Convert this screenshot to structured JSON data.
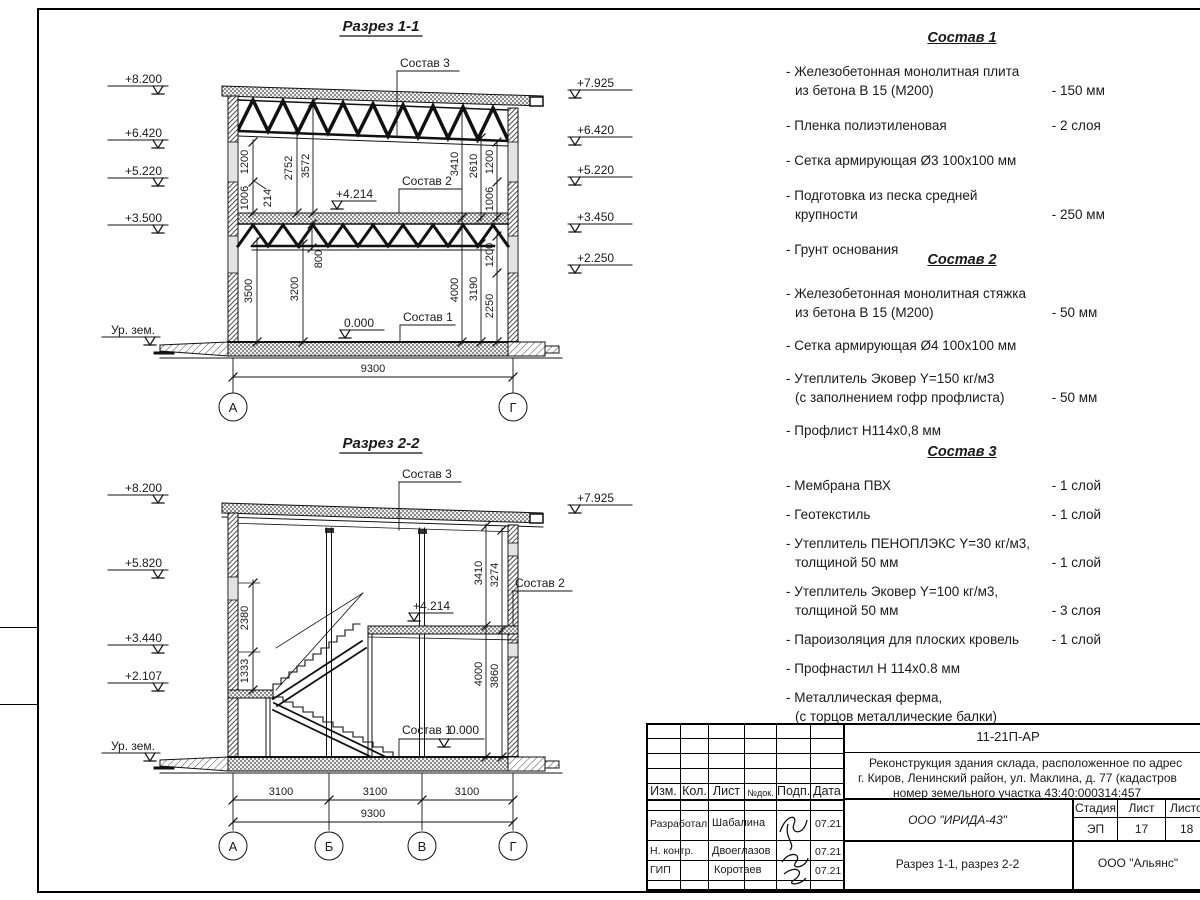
{
  "labels": {
    "c1": "Состав 1",
    "c2": "Состав 2",
    "c3": "Состав 3"
  },
  "s1": {
    "title": "Разрез 1-1",
    "elev_left": [
      "+8.200",
      "+6.420",
      "+5.220",
      "+3.500"
    ],
    "elev_right": [
      "+7.925",
      "+6.420",
      "+5.220",
      "+3.450",
      "+2.250"
    ],
    "ground": "Ур. зем.",
    "du_left": [
      "1200",
      "1006",
      "214",
      "2752",
      "3572"
    ],
    "du_right": [
      "3410",
      "2610",
      "1200",
      "1006"
    ],
    "dl_left": [
      "3500",
      "3200",
      "800"
    ],
    "dl_right": [
      "4000",
      "3190",
      "2250",
      "1200"
    ],
    "lvl_mid": "+4.214",
    "lvl_zero": "0.000",
    "span": "9300",
    "axes": [
      "А",
      "Г"
    ]
  },
  "s2": {
    "title": "Разрез 2-2",
    "elev_left": [
      "+8.200",
      "+5.820",
      "+3.440",
      "+2.107"
    ],
    "elev_right": [
      "+7.925"
    ],
    "ground": "Ур. зем.",
    "d_left": [
      "2380",
      "1333"
    ],
    "d_right_up": [
      "3410",
      "3274"
    ],
    "d_right_low": [
      "4000",
      "3860"
    ],
    "lvl_mid": "+4.214",
    "lvl_zero": "0.000",
    "spans": [
      "3100",
      "3100",
      "3100"
    ],
    "total": "9300",
    "axes": [
      "А",
      "Б",
      "В",
      "Г"
    ]
  },
  "compositions": [
    {
      "title": "Состав 1",
      "items": [
        {
          "text": "- Железобетонная  монолитная плита\nиз бетона В 15 (М200)",
          "value": "- 150 мм"
        },
        {
          "text": "- Пленка полиэтиленовая",
          "value": "- 2 слоя"
        },
        {
          "text": "- Сетка армирующая Ø3 100х100 мм",
          "value": ""
        },
        {
          "text": "- Подготовка из песка средней\nкрупности",
          "value": "- 250 мм"
        },
        {
          "text": "- Грунт основания",
          "value": ""
        }
      ]
    },
    {
      "title": "Состав 2",
      "items": [
        {
          "text": "- Железобетонная  монолитная стяжка\nиз бетона В 15 (М200)",
          "value": "- 50 мм"
        },
        {
          "text": "- Сетка армирующая Ø4 100х100 мм",
          "value": ""
        },
        {
          "text": "- Утеплитель Эковер Y=150 кг/м3\n(с заполнением гофр профлиста)",
          "value": "- 50 мм"
        },
        {
          "text": "- Профлист Н114х0,8 мм",
          "value": ""
        }
      ]
    },
    {
      "title": "Состав 3",
      "items": [
        {
          "text": "- Мембрана ПВХ",
          "value": "- 1 слой"
        },
        {
          "text": "- Геотекстиль",
          "value": "- 1 слой"
        },
        {
          "text": "- Утеплитель ПЕНОПЛЭКС Y=30 кг/м3,\nтолщиной 50 мм",
          "value": "- 1 слой"
        },
        {
          "text": "- Утеплитель Эковер Y=100 кг/м3,\nтолщиной 50 мм",
          "value": "- 3 слоя"
        },
        {
          "text": "- Пароизоляция для плоских кровель",
          "value": "- 1 слой"
        },
        {
          "text": "- Профнастил Н 114х0.8 мм",
          "value": ""
        },
        {
          "text": "- Металлическая ферма,\n(с торцов металлические балки)",
          "value": ""
        }
      ]
    }
  ],
  "titleblock": {
    "code": "11-21П-АР",
    "desc1": "Реконструкция здания склада, расположенное по адрес",
    "desc2": "г. Киров, Ленинский район, ул. Маклина, д. 77 (кадастров",
    "desc3": "номер земельного участка 43:40:000314:457",
    "cols": [
      "Изм.",
      "Кол.",
      "Лист",
      "№док.",
      "Подп.",
      "Дата"
    ],
    "rows": [
      {
        "role": "Разработал",
        "name": "Шабалина",
        "date": "07.21"
      },
      {
        "role": "Н. контр.",
        "name": "Двоеглазов",
        "date": "07.21"
      },
      {
        "role": "ГИП",
        "name": "Коротаев",
        "date": "07.21"
      }
    ],
    "org": "ООО \"ИРИДА-43\"",
    "stage_label": "Стадия",
    "sheet_label": "Лист",
    "sheets_label": "Листов",
    "stage": "ЭП",
    "sheet": "17",
    "sheets": "18",
    "doc_title": "Разрез 1-1, разрез 2-2",
    "firm": "ООО \"Альянс\""
  }
}
